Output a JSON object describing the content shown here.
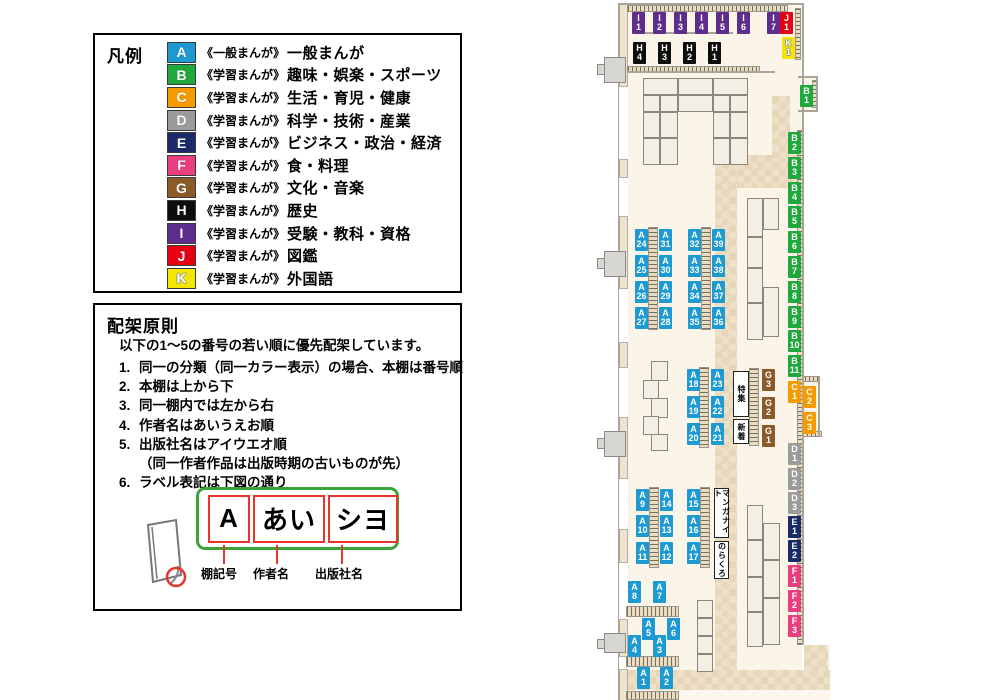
{
  "legend": {
    "title": "凡例",
    "items": [
      {
        "code": "A",
        "label_type": "《一般まんが》",
        "category": "一般まんが",
        "color": "#1e9ad2"
      },
      {
        "code": "B",
        "label_type": "《学習まんが》",
        "category": "趣味・娯楽・スポーツ",
        "color": "#1fa83c"
      },
      {
        "code": "C",
        "label_type": "《学習まんが》",
        "category": "生活・育児・健康",
        "color": "#f59b00"
      },
      {
        "code": "D",
        "label_type": "《学習まんが》",
        "category": "科学・技術・産業",
        "color": "#9b9b9b"
      },
      {
        "code": "E",
        "label_type": "《学習まんが》",
        "category": "ビジネス・政治・経済",
        "color": "#1d2a69"
      },
      {
        "code": "F",
        "label_type": "《学習まんが》",
        "category": "食・料理",
        "color": "#ea3f7e"
      },
      {
        "code": "G",
        "label_type": "《学習まんが》",
        "category": "文化・音楽",
        "color": "#8a5a28"
      },
      {
        "code": "H",
        "label_type": "《学習まんが》",
        "category": "歴史",
        "color": "#0d0d0d"
      },
      {
        "code": "I",
        "label_type": "《学習まんが》",
        "category": "受験・教科・資格",
        "color": "#5f2d8c"
      },
      {
        "code": "J",
        "label_type": "《学習まんが》",
        "category": "図鑑",
        "color": "#e60013"
      },
      {
        "code": "K",
        "label_type": "《学習まんが》",
        "category": "外国語",
        "color": "#f4e600"
      }
    ]
  },
  "principles": {
    "title": "配架原則",
    "intro": "以下の1〜5の番号の若い順に優先配架しています。",
    "rules": [
      {
        "num": "1.",
        "text": "同一の分類（同一カラー表示）の場合、本棚は番号順",
        "indent": false
      },
      {
        "num": "2.",
        "text": "本棚は上から下",
        "indent": false
      },
      {
        "num": "3.",
        "text": "同一棚内では左から右",
        "indent": false
      },
      {
        "num": "4.",
        "text": "作者名はあいうえお順",
        "indent": false
      },
      {
        "num": "5.",
        "text": "出版社名はアイウエオ順",
        "indent": false
      },
      {
        "num": "",
        "text": "（同一作者作品は出版時期の古いものが先）",
        "indent": true
      },
      {
        "num": "6.",
        "text": "ラベル表記は下図の通り",
        "indent": false
      }
    ],
    "diagram": {
      "segments": [
        {
          "text": "A",
          "caption": "棚記号"
        },
        {
          "text": "あい",
          "caption": "作者名"
        },
        {
          "text": "シヨ",
          "caption": "出版社名"
        }
      ]
    }
  },
  "map": {
    "feature_boxes": [
      {
        "text": "特集",
        "x": 733,
        "y": 371,
        "w": 16,
        "h": 46
      },
      {
        "text": "新着",
        "x": 733,
        "y": 419,
        "w": 16,
        "h": 25
      },
      {
        "text": "マンガナイト",
        "x": 714,
        "y": 488,
        "w": 15,
        "h": 50
      },
      {
        "text": "のらくろ",
        "x": 714,
        "y": 541,
        "w": 15,
        "h": 38
      }
    ],
    "shelf_labels": [
      {
        "t": "I1",
        "c": "I",
        "x": 632,
        "y": 12
      },
      {
        "t": "I2",
        "c": "I",
        "x": 653,
        "y": 12
      },
      {
        "t": "I3",
        "c": "I",
        "x": 674,
        "y": 12
      },
      {
        "t": "I4",
        "c": "I",
        "x": 695,
        "y": 12
      },
      {
        "t": "I5",
        "c": "I",
        "x": 716,
        "y": 12
      },
      {
        "t": "I6",
        "c": "I",
        "x": 737,
        "y": 12
      },
      {
        "t": "I7",
        "c": "I",
        "x": 767,
        "y": 12
      },
      {
        "t": "J1",
        "c": "J",
        "x": 780,
        "y": 12
      },
      {
        "t": "K1",
        "c": "K",
        "x": 782,
        "y": 37
      },
      {
        "t": "H4",
        "c": "H",
        "x": 633,
        "y": 42
      },
      {
        "t": "H3",
        "c": "H",
        "x": 658,
        "y": 42
      },
      {
        "t": "H2",
        "c": "H",
        "x": 683,
        "y": 42
      },
      {
        "t": "H1",
        "c": "H",
        "x": 708,
        "y": 42
      },
      {
        "t": "B1",
        "c": "B",
        "x": 800,
        "y": 85
      },
      {
        "t": "B2",
        "c": "B",
        "x": 788,
        "y": 132
      },
      {
        "t": "B3",
        "c": "B",
        "x": 788,
        "y": 157
      },
      {
        "t": "B4",
        "c": "B",
        "x": 788,
        "y": 182
      },
      {
        "t": "B5",
        "c": "B",
        "x": 788,
        "y": 206
      },
      {
        "t": "B6",
        "c": "B",
        "x": 788,
        "y": 231
      },
      {
        "t": "B7",
        "c": "B",
        "x": 788,
        "y": 256
      },
      {
        "t": "B8",
        "c": "B",
        "x": 788,
        "y": 281
      },
      {
        "t": "B9",
        "c": "B",
        "x": 788,
        "y": 306
      },
      {
        "t": "B10",
        "c": "B",
        "x": 788,
        "y": 330
      },
      {
        "t": "B11",
        "c": "B",
        "x": 788,
        "y": 355
      },
      {
        "t": "C1",
        "c": "C",
        "x": 788,
        "y": 381
      },
      {
        "t": "C2",
        "c": "C",
        "x": 803,
        "y": 386
      },
      {
        "t": "C3",
        "c": "C",
        "x": 803,
        "y": 412
      },
      {
        "t": "D1",
        "c": "D",
        "x": 788,
        "y": 443
      },
      {
        "t": "D2",
        "c": "D",
        "x": 788,
        "y": 468
      },
      {
        "t": "D3",
        "c": "D",
        "x": 788,
        "y": 492
      },
      {
        "t": "E1",
        "c": "E",
        "x": 788,
        "y": 516
      },
      {
        "t": "E2",
        "c": "E",
        "x": 788,
        "y": 540
      },
      {
        "t": "F1",
        "c": "F",
        "x": 788,
        "y": 565
      },
      {
        "t": "F2",
        "c": "F",
        "x": 788,
        "y": 590
      },
      {
        "t": "F3",
        "c": "F",
        "x": 788,
        "y": 615
      },
      {
        "t": "G3",
        "c": "G",
        "x": 762,
        "y": 369
      },
      {
        "t": "G2",
        "c": "G",
        "x": 762,
        "y": 397
      },
      {
        "t": "G1",
        "c": "G",
        "x": 762,
        "y": 425
      },
      {
        "t": "A24",
        "c": "A",
        "x": 635,
        "y": 229
      },
      {
        "t": "A31",
        "c": "A",
        "x": 659,
        "y": 229
      },
      {
        "t": "A25",
        "c": "A",
        "x": 635,
        "y": 255
      },
      {
        "t": "A30",
        "c": "A",
        "x": 659,
        "y": 255
      },
      {
        "t": "A26",
        "c": "A",
        "x": 635,
        "y": 281
      },
      {
        "t": "A29",
        "c": "A",
        "x": 659,
        "y": 281
      },
      {
        "t": "A27",
        "c": "A",
        "x": 635,
        "y": 307
      },
      {
        "t": "A28",
        "c": "A",
        "x": 659,
        "y": 307
      },
      {
        "t": "A32",
        "c": "A",
        "x": 688,
        "y": 229
      },
      {
        "t": "A39",
        "c": "A",
        "x": 712,
        "y": 229
      },
      {
        "t": "A33",
        "c": "A",
        "x": 688,
        "y": 255
      },
      {
        "t": "A38",
        "c": "A",
        "x": 712,
        "y": 255
      },
      {
        "t": "A34",
        "c": "A",
        "x": 688,
        "y": 281
      },
      {
        "t": "A37",
        "c": "A",
        "x": 712,
        "y": 281
      },
      {
        "t": "A35",
        "c": "A",
        "x": 688,
        "y": 307
      },
      {
        "t": "A36",
        "c": "A",
        "x": 712,
        "y": 307
      },
      {
        "t": "A18",
        "c": "A",
        "x": 687,
        "y": 369
      },
      {
        "t": "A23",
        "c": "A",
        "x": 711,
        "y": 369
      },
      {
        "t": "A19",
        "c": "A",
        "x": 687,
        "y": 396
      },
      {
        "t": "A22",
        "c": "A",
        "x": 711,
        "y": 396
      },
      {
        "t": "A20",
        "c": "A",
        "x": 687,
        "y": 423
      },
      {
        "t": "A21",
        "c": "A",
        "x": 711,
        "y": 423
      },
      {
        "t": "A9",
        "c": "A",
        "x": 636,
        "y": 489
      },
      {
        "t": "A14",
        "c": "A",
        "x": 660,
        "y": 489
      },
      {
        "t": "A10",
        "c": "A",
        "x": 636,
        "y": 515
      },
      {
        "t": "A13",
        "c": "A",
        "x": 660,
        "y": 515
      },
      {
        "t": "A11",
        "c": "A",
        "x": 636,
        "y": 542
      },
      {
        "t": "A12",
        "c": "A",
        "x": 660,
        "y": 542
      },
      {
        "t": "A15",
        "c": "A",
        "x": 687,
        "y": 489
      },
      {
        "t": "A16",
        "c": "A",
        "x": 687,
        "y": 515
      },
      {
        "t": "A17",
        "c": "A",
        "x": 687,
        "y": 542
      },
      {
        "t": "A8",
        "c": "A",
        "x": 628,
        "y": 581
      },
      {
        "t": "A7",
        "c": "A",
        "x": 653,
        "y": 581
      },
      {
        "t": "A5",
        "c": "A",
        "x": 642,
        "y": 618
      },
      {
        "t": "A6",
        "c": "A",
        "x": 667,
        "y": 618
      },
      {
        "t": "A4",
        "c": "A",
        "x": 628,
        "y": 635
      },
      {
        "t": "A3",
        "c": "A",
        "x": 653,
        "y": 635
      },
      {
        "t": "A1",
        "c": "A",
        "x": 637,
        "y": 667
      },
      {
        "t": "A2",
        "c": "A",
        "x": 660,
        "y": 667
      }
    ]
  }
}
